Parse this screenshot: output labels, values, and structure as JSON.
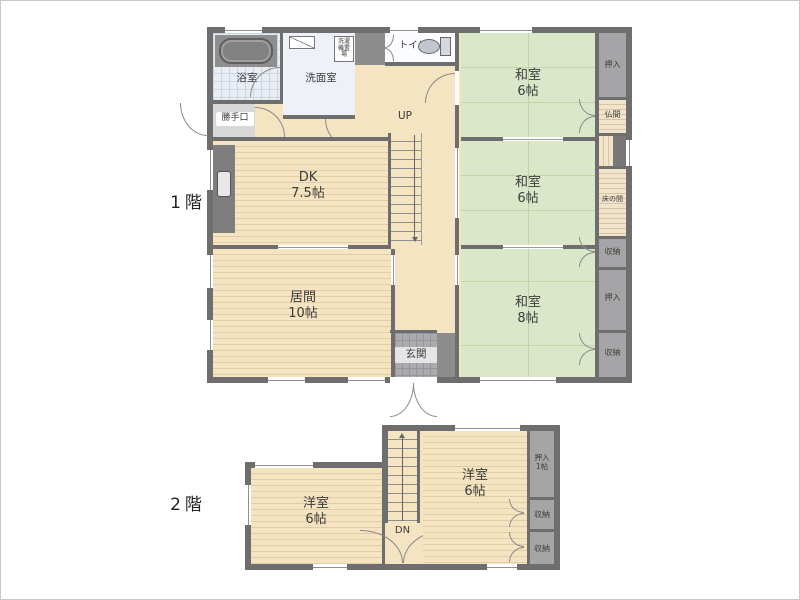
{
  "palette": {
    "wall": "#6e6e6e",
    "tatami": "#dbe7c9",
    "wood_floor": "#f4e4c2",
    "closet": "#a5a5a7",
    "alcove_wood": "#f2e3cd",
    "bath_floor": "#e9edf4",
    "entrance_tile": "#ababae"
  },
  "floor1": {
    "label": "1階",
    "bath": "浴室",
    "washroom": "洗面室",
    "washer_storage": "洗濯機置場",
    "toilet": "トイレ",
    "back_door": "勝手口",
    "stairs_up": "UP",
    "dk_name": "DK",
    "dk_size": "7.5帖",
    "living_name": "居間",
    "living_size": "10帖",
    "entrance": "玄関",
    "washitsu1_name": "和室",
    "washitsu1_size": "6帖",
    "washitsu2_name": "和室",
    "washitsu2_size": "6帖",
    "washitsu3_name": "和室",
    "washitsu3_size": "8帖",
    "oshiire_top": "押入",
    "butsuma": "仏間",
    "tokonoma": "床の間",
    "shuno_mid": "収納",
    "oshiire_mid": "押入",
    "shuno_bottom": "収納"
  },
  "floor2": {
    "label": "2階",
    "west_room_left_name": "洋室",
    "west_room_left_size": "6帖",
    "west_room_right_name": "洋室",
    "west_room_right_size": "6帖",
    "stairs_down": "DN",
    "oshiire_name": "押入",
    "oshiire_size": "1帖",
    "shuno1": "収納",
    "shuno2": "収納"
  }
}
